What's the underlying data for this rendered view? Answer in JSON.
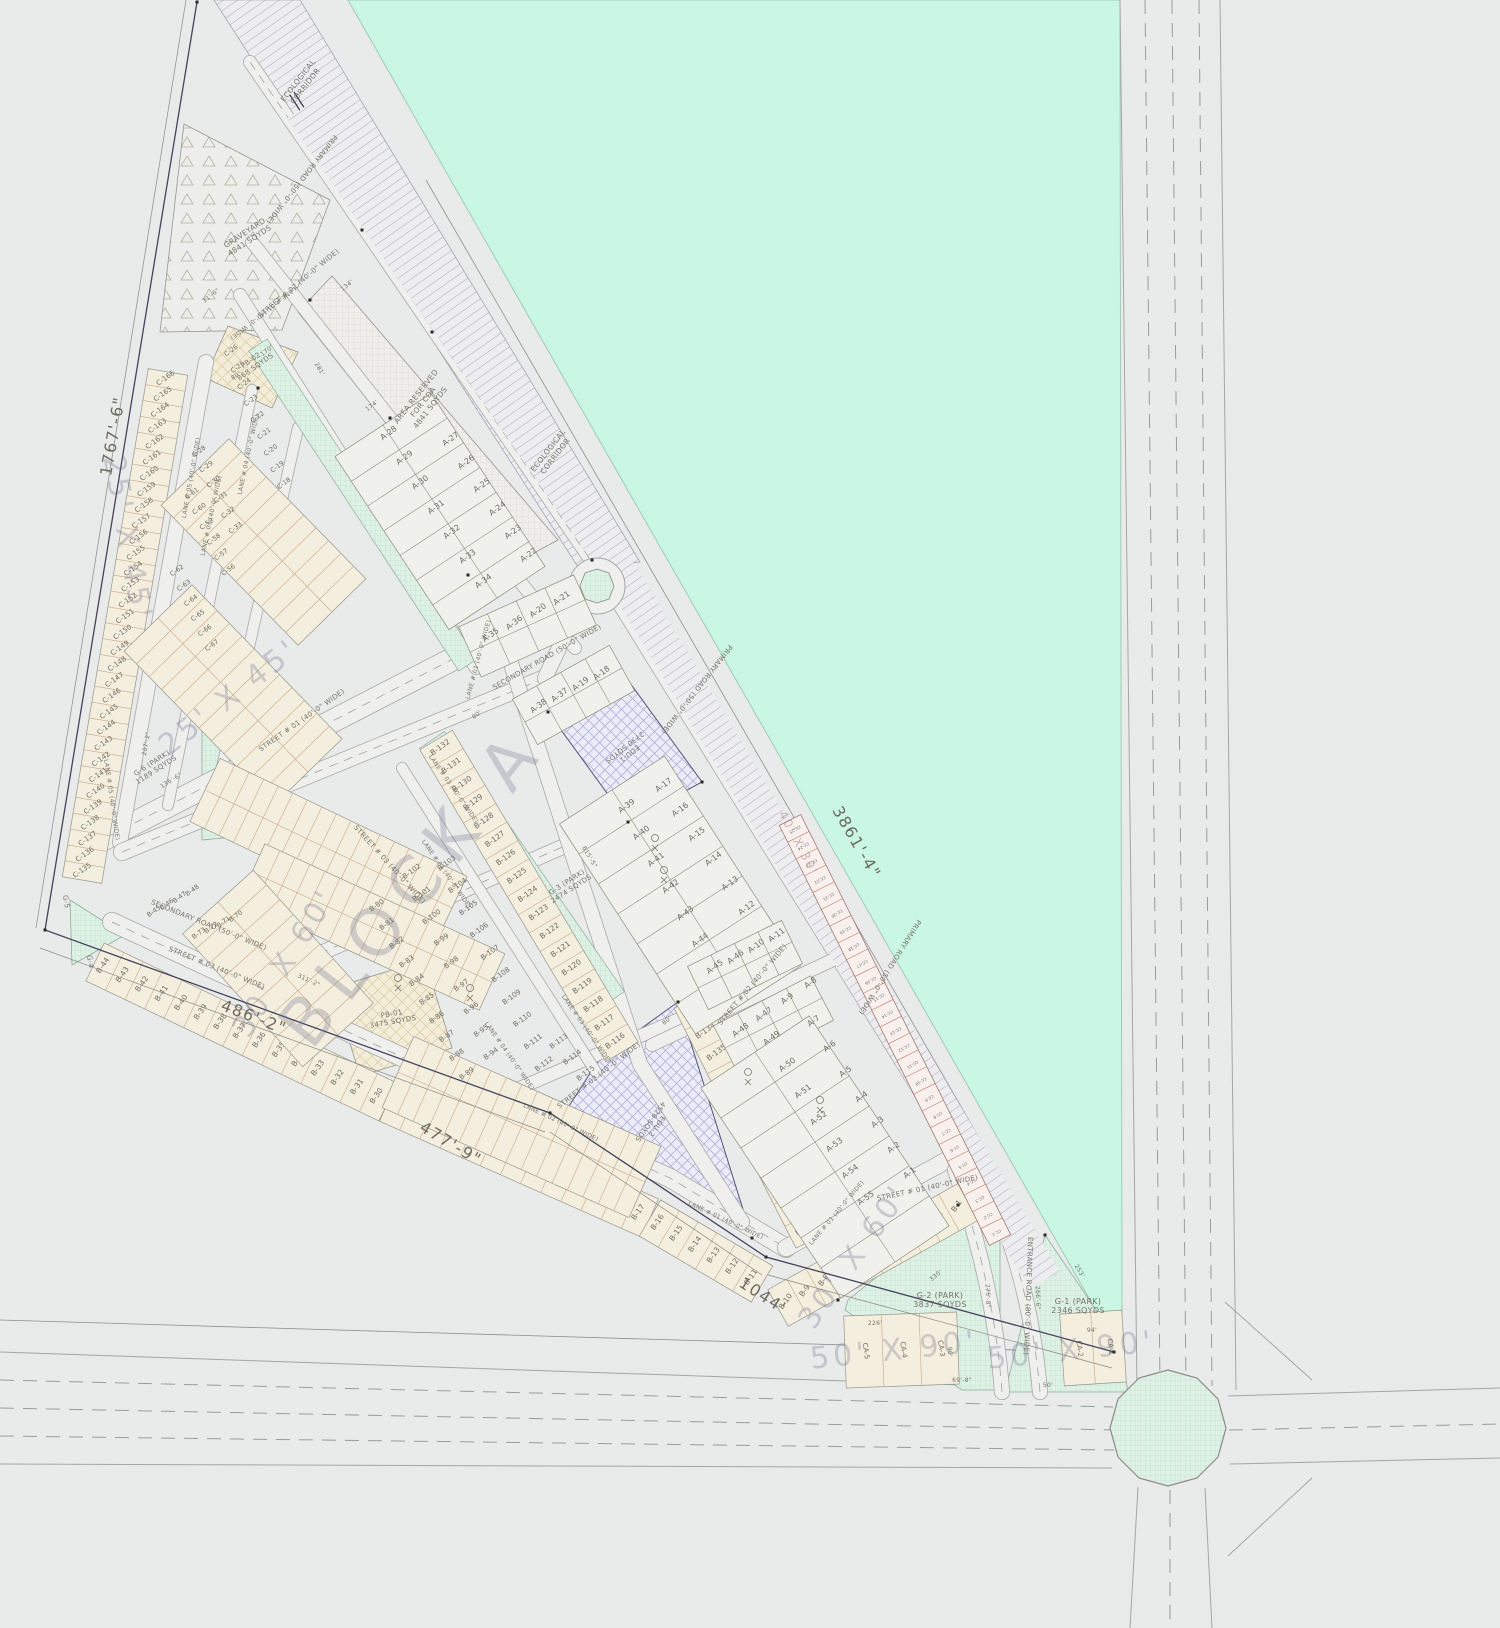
{
  "palette": {
    "teal": "#c9f7e4",
    "plot": "#ebecea",
    "road_fill": "#eff0ee",
    "strip": "#f3eedd",
    "park": "#def1e5",
    "edu": "#ececf8",
    "accent_red": "#c4766b",
    "line_dark": "#33334a"
  },
  "corridor_label": {
    "lines": [
      "ECOLOGICAL",
      "CORRIDOR"
    ]
  },
  "graveyard": {
    "lines": [
      "GRAVEYARD",
      "4841 SQYDS"
    ]
  },
  "area_reserved": {
    "lines": [
      "AREA RESERVED",
      "FOR CDA",
      "4841 SQYDS"
    ]
  },
  "plots": {
    "pb02": {
      "lines": [
        "PB-02",
        "868 SQYDS"
      ]
    },
    "pb01": {
      "lines": [
        "PB-01",
        "3475 SQYDS"
      ]
    },
    "edu1": {
      "lines": [
        "EDU-1",
        "2730 SQYDS"
      ]
    },
    "edu2": {
      "lines": [
        "EDU-2",
        "4528 SQYDS"
      ]
    }
  },
  "parks": {
    "g1": {
      "lines": [
        "G-1 (PARK)",
        "2346 SQYDS"
      ]
    },
    "g2": {
      "lines": [
        "G-2 (PARK)",
        "3837 SQYDS"
      ]
    },
    "g3": {
      "lines": [
        "G-3 (PARK)",
        "2474 SQYDS"
      ]
    },
    "g6": {
      "lines": [
        "G-6 (PARK)",
        "1189 SQYDS"
      ]
    },
    "g4": "G-4",
    "g5": "G-5"
  },
  "roads": {
    "primary": "PRIMARY ROAD (50'-0\" WIDE)",
    "secondary": "SECONDARY ROAD (50'-0\" WIDE)",
    "entrance": "ENTRANCE ROAD (80'-0\" WIDE)",
    "street01": "STREET # 01 (40'-0\" WIDE)",
    "street02": "STREET # 02 (40'-0\" WIDE)",
    "street03": "STREET # 03 (40'-0\" WIDE)",
    "lane01": "LANE # 01 (40'-0\" WIDE)",
    "lane02": "LANE # 02 (40'-0\" WIDE)",
    "lane03": "LANE # 03 (40'-0\" WIDE)",
    "lane04": "LANE # 04 (40'-0\" WIDE)",
    "lane05": "LANE # 05 (40'-0\" WIDE)"
  },
  "dims": {
    "west": "1767'-6\"",
    "northeast": "3861'-4\"",
    "sw1": "486'-2\"",
    "sw2": "477'-9\"",
    "south": "1044'",
    "d134": "134'",
    "d316": "31'-6\"",
    "d174": "174'",
    "d170": "170'",
    "d281": "281'",
    "d80": "80'",
    "d6155": "615'-5\"",
    "d3112": "311'-2\"",
    "d2072": "207'-2\"",
    "d1366": "136'-6\"",
    "d226": "226'",
    "d330": "330'",
    "d94": "94'",
    "d253": "253'",
    "d2758": "275'-8\"",
    "d2666": "266'-6\"",
    "d698": "69'-8\"",
    "d50": "50'",
    "d90": "90'"
  },
  "blocks": {
    "ghost": "BLOCK A",
    "size_a": "50' X 90'",
    "size_b": "30' X 60'",
    "size_c": "25' X 45'",
    "size_cc": "40' X 30'"
  },
  "lots": {
    "a": {
      "prefix": "A-",
      "from": 1,
      "to": 55
    },
    "b": {
      "prefix": "B-",
      "from": 1,
      "to": 145
    },
    "c": {
      "prefix": "C-",
      "from": 1,
      "to": 166
    },
    "cc": {
      "prefix": "CC-",
      "from": 1,
      "to": 25
    },
    "ca": {
      "prefix": "CA-",
      "from": 1,
      "to": 5
    }
  }
}
